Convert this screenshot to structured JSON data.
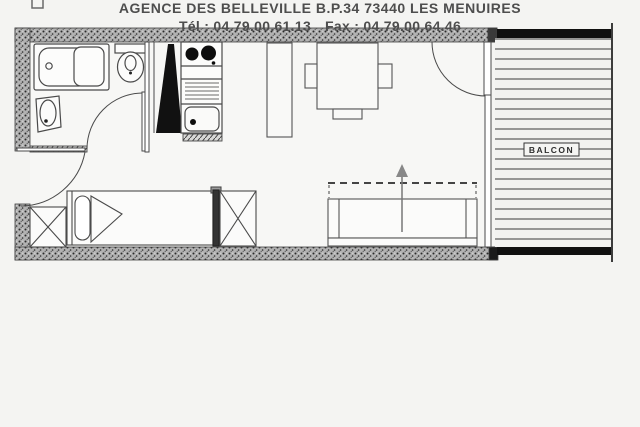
{
  "plan": {
    "balcony_label": "BALCON"
  },
  "footer": {
    "line1": "AGENCE DES BELLEVILLE B.P.34 73440 LES MENUIRES",
    "tel": "Tél : 04.79.00.61.13",
    "fax": "Fax : 04.79.00.64.46"
  },
  "colors": {
    "background": "#f4f4f2",
    "line": "#4a4a4a",
    "wall_fill": "#b2b2b2",
    "solid_black": "#101010",
    "text": "#4e4e4e"
  }
}
